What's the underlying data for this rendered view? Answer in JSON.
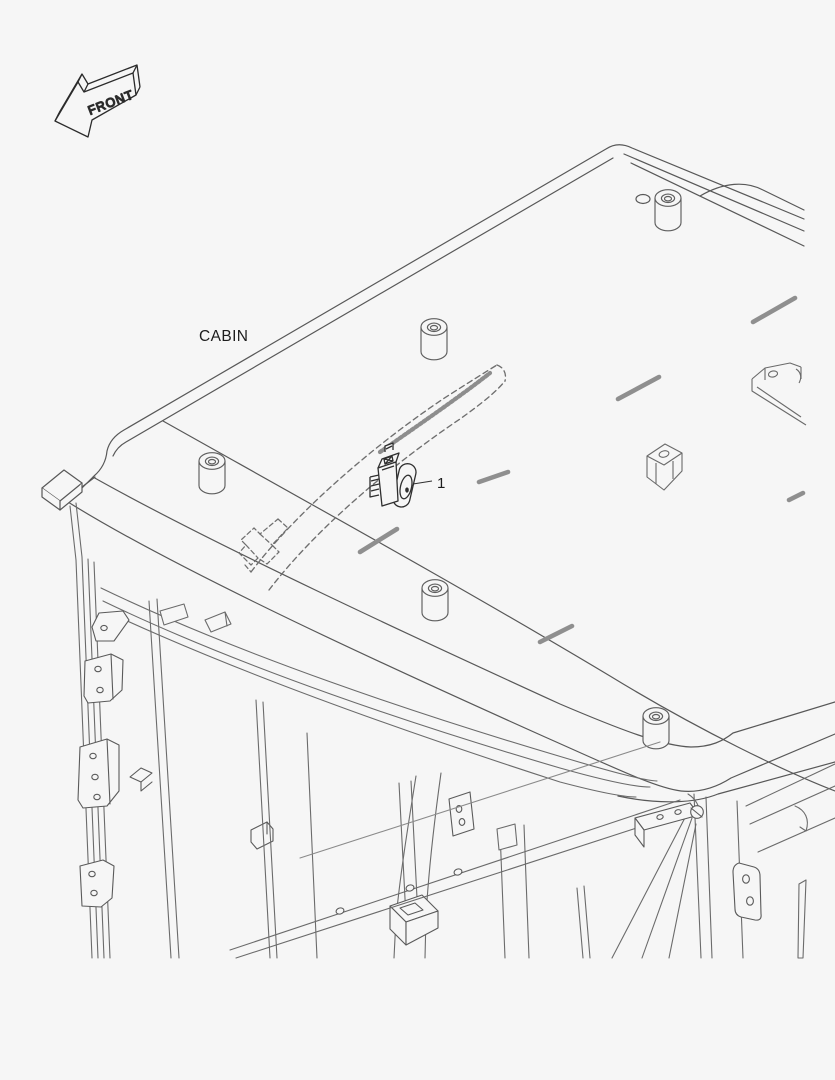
{
  "canvas": {
    "width": 835,
    "height": 1080,
    "background": "#f6f6f6"
  },
  "colors": {
    "ink": "#2f2f2f",
    "roof_line": "#585858",
    "frame_line": "#6b6b6b",
    "dash_mark": "#8f8f8f",
    "harness": "#6f6f6f"
  },
  "labels": {
    "front_arrow": "FRONT",
    "cabin": "CABIN",
    "callout_1": "1"
  }
}
